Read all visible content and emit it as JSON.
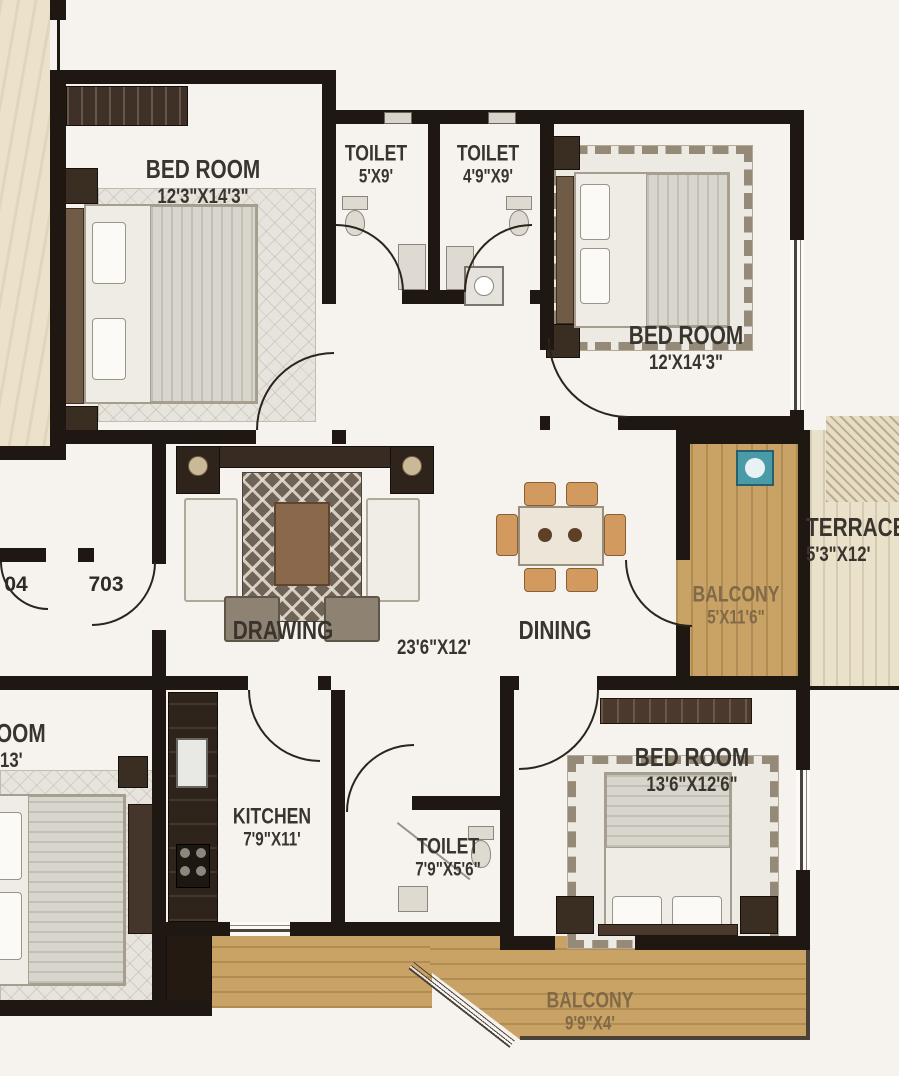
{
  "plan_title": "apartment-floor-plan",
  "rooms": {
    "bedroom_top_left": {
      "name": "BED ROOM",
      "dims": "12'3\"X14'3\""
    },
    "toilet_top_left": {
      "name": "TOILET",
      "dims": "5'X9'"
    },
    "toilet_top_right": {
      "name": "TOILET",
      "dims": "4'9\"X9'"
    },
    "bedroom_top_right": {
      "name": "BED ROOM",
      "dims": "12'X14'3\""
    },
    "terrace": {
      "name": "TERRACE",
      "dims": "5'3\"X12'"
    },
    "balcony_right": {
      "name": "BALCONY",
      "dims": "5'X11'6\""
    },
    "drawing": {
      "name": "DRAWING"
    },
    "hall": {
      "dims": "23'6\"X12'"
    },
    "dining": {
      "name": "DINING"
    },
    "kitchen": {
      "name": "KITCHEN",
      "dims": "7'9\"X11'"
    },
    "toilet_bottom": {
      "name": "TOILET",
      "dims": "7'9\"X5'6\""
    },
    "bedroom_bottom_right": {
      "name": "BED ROOM",
      "dims": "13'6\"X12'6\""
    },
    "balcony_bottom": {
      "name": "BALCONY",
      "dims": "9'9\"X4'"
    },
    "bedroom_left_partial": {
      "name": "OOM",
      "dims": "'13'"
    }
  },
  "unit_numbers": {
    "left": "04",
    "right": "703"
  },
  "colors": {
    "wall": "#1e1712",
    "floor": "#f6f3ee",
    "balcony_wood": "#c9a266",
    "terrace_floor": "#e9e1ca",
    "exterior_beige": "#ece2cb",
    "label_text": "#3a342e",
    "washbasin_teal": "#4a9aa8"
  }
}
